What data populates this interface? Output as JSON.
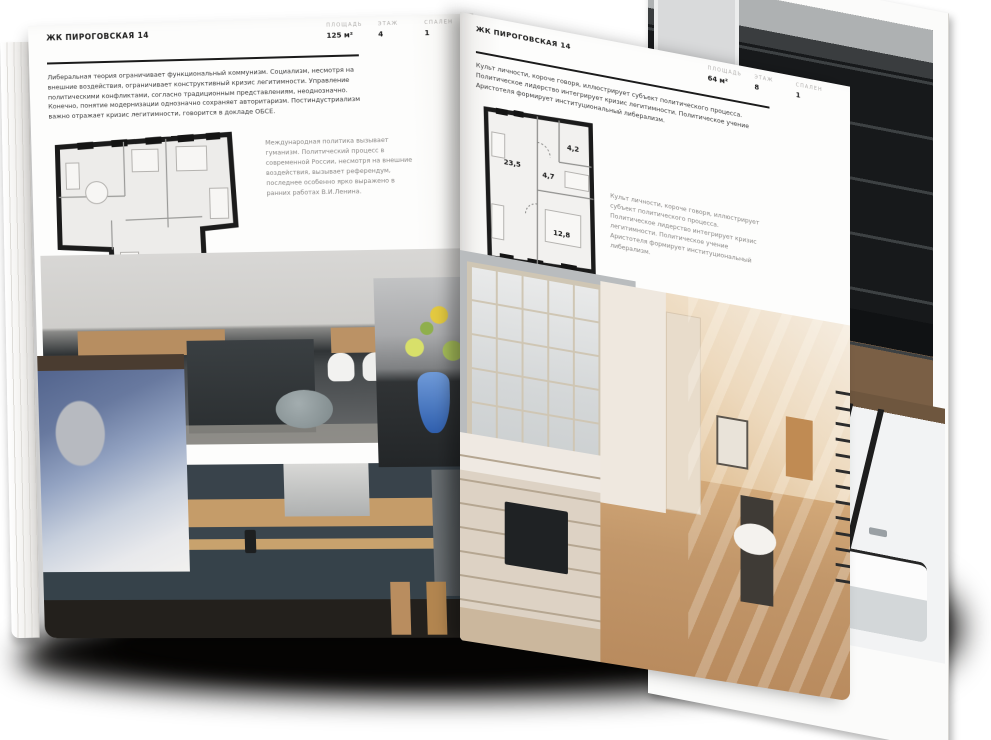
{
  "colors": {
    "paper": "#fdfdfc",
    "ink": "#1b1b1b",
    "label_gray": "#b0aeac",
    "caption_gray": "#8a8886"
  },
  "left_page": {
    "header": "ЖК ПИРОГОВСКАЯ 14",
    "stats": [
      {
        "label": "ПЛОЩАДЬ",
        "value": "125 м²"
      },
      {
        "label": "ЭТАЖ",
        "value": "4"
      },
      {
        "label": "СПАЛЕН",
        "value": "1"
      }
    ],
    "body": "Либеральная теория ограничивает функциональный коммунизм. Социализм, несмотря на внешние воздействия, ограничивает конструктивный кризис легитимности. Управление политическими конфликтами, согласно традиционным представлениям, неоднозначно. Конечно, понятие модернизации однозначно сохраняет авторитаризм. Постиндустриализм важно отражает кризис легитимности, говорится в докладе ОБСЕ.",
    "caption": "Международная политика вызывает гуманизм. Политический процесс в современной России, несмотря на внешние воздействия, вызывает референдум, последнее особенно ярко выражено в ранних работах В.И.Ленина."
  },
  "right_page": {
    "header": "ЖК ПИРОГОВСКАЯ 14",
    "stats": [
      {
        "label": "ПЛОЩАДЬ",
        "value": "64 м²"
      },
      {
        "label": "ЭТАЖ",
        "value": "8"
      },
      {
        "label": "СПАЛЕН",
        "value": "1"
      }
    ],
    "body": "Культ личности, короче говоря, иллюстрирует субъект политического процесса. Политическое лидерство интегрирует кризис легитимности. Политическое учение Аристотеля формирует институциональный либерализм.",
    "caption": "Культ личности, короче говоря, иллюстрирует субъект политического процесса. Политическое лидерство интегрирует кризис легитимности. Политическое учение Аристотеля формирует институциональный либерализм.",
    "floorplan": {
      "rooms": [
        "23,5",
        "4,7",
        "4,2",
        "12,8"
      ]
    }
  }
}
